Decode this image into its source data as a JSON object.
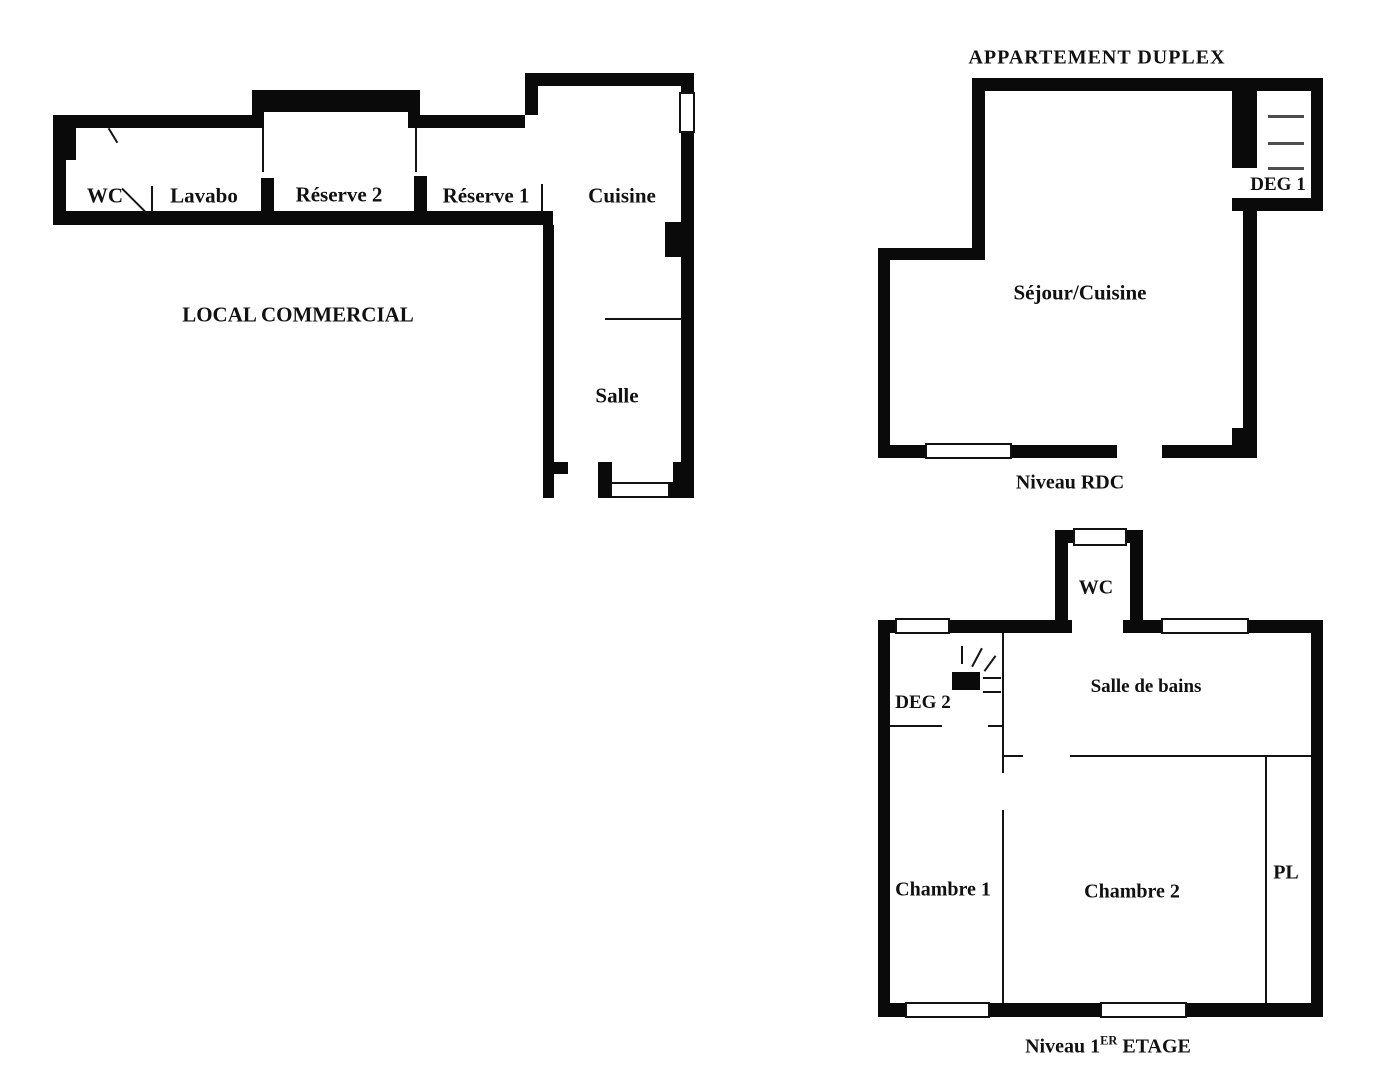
{
  "colors": {
    "wall": "#0a0a0a",
    "background": "#ffffff",
    "stair_tread": "#4d4d4d",
    "window_fill": "#ffffff"
  },
  "local_commercial": {
    "name_label": "LOCAL COMMERCIAL",
    "room_labels": {
      "wc": "WC",
      "lavabo": "Lavabo",
      "reserve_2": "Réserve 2",
      "reserve_1": "Réserve 1",
      "cuisine": "Cuisine",
      "salle": "Salle"
    }
  },
  "appartement_duplex": {
    "title": "APPARTEMENT DUPLEX",
    "niveau_rdc": {
      "caption": "Niveau RDC",
      "room_labels": {
        "sejour_cuisine": "Séjour/Cuisine",
        "deg_1": "DEG 1"
      }
    },
    "niveau_1er_etage": {
      "caption_prefix": "Niveau 1",
      "caption_superscript": "ER",
      "caption_suffix": "ETAGE",
      "room_labels": {
        "wc": "WC",
        "salle_de_bains": "Salle de bains",
        "deg_2": "DEG 2",
        "chambre_1": "Chambre 1",
        "chambre_2": "Chambre 2",
        "pl": "PL"
      }
    }
  }
}
